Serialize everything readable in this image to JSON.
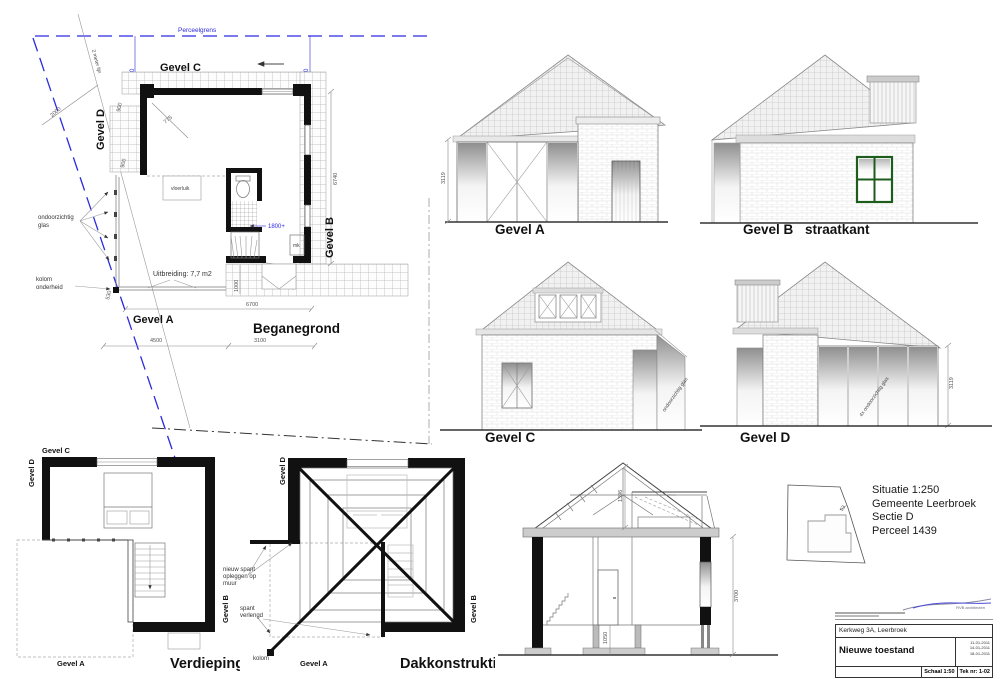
{
  "colors": {
    "perceel_blue": "#2b2be0",
    "dim_blue": "#3c3ce8",
    "window_green": "#1e5c1e",
    "ink": "#111111"
  },
  "site": {
    "perceelgrens": "Perceelgrens",
    "two_meter_line": "2 meter lijn",
    "dim_2000": "2000",
    "dim_1950": "1950",
    "dim_1930": "1930"
  },
  "plan_ground": {
    "title": "Beganegrond",
    "gevel_a": "Gevel A",
    "gevel_b": "Gevel B",
    "gevel_c": "Gevel C",
    "gevel_d": "Gevel D",
    "vloerluik": "vloerluik",
    "glas": [
      "ondoorzichtig",
      "glas"
    ],
    "kolom": [
      "kolom",
      "onderheid"
    ],
    "uitbreiding": "Uitbreiding: 7,7 m2",
    "mk": "mk",
    "dim_900_top": "900",
    "dim_775": "775",
    "dim_900_left": "900",
    "dim_530": "530",
    "dim_4500": "4500",
    "dim_3100": "3100",
    "dim_6700": "6700",
    "dim_6740": "6740",
    "dim_1000": "1000",
    "dim_1800": "1800+"
  },
  "elev_a": {
    "label": "Gevel A",
    "dim_3119": "3119"
  },
  "elev_b": {
    "label": "Gevel B",
    "sublabel": "straatkant"
  },
  "elev_c": {
    "label": "Gevel C",
    "glas_note": "ondoorzichtig glas"
  },
  "elev_d": {
    "label": "Gevel D",
    "glas_note": "4x ondoorzichtig glas",
    "dim_3119": "3119"
  },
  "plan_first": {
    "title": "Verdieping",
    "gevel_a": "Gevel A",
    "gevel_b": "Gevel B",
    "gevel_c": "Gevel C",
    "gevel_d": "Gevel D"
  },
  "plan_roof": {
    "title": "Dakkonstruktie",
    "gevel_a": "Gevel A",
    "gevel_b": "Gevel B",
    "gevel_d": "Gevel D",
    "kolom": "kolom",
    "note_spant": [
      "nieuw spant",
      "opleggen op",
      "muur"
    ],
    "note_verlengd": [
      "spant",
      "verlengd"
    ]
  },
  "section": {
    "dim_1396": "1396",
    "dim_3700": "3700",
    "dim_1050": "1050"
  },
  "situatie": {
    "line1": "Situatie 1:250",
    "line2": "Gemeente Leerbroek",
    "line3": "Sectie D",
    "line4": "Perceel 1439",
    "parcel": "53"
  },
  "titleblock": {
    "logo": "RVB architecten",
    "address": "Kerkweg 3A, Leerbroek",
    "title": "Nieuwe toestand",
    "dates": [
      "11-01-2011",
      "14-01-2011",
      "18-01-2011"
    ],
    "scale": "Schaal 1:50",
    "sheet": "Tek nr: 1-02"
  }
}
